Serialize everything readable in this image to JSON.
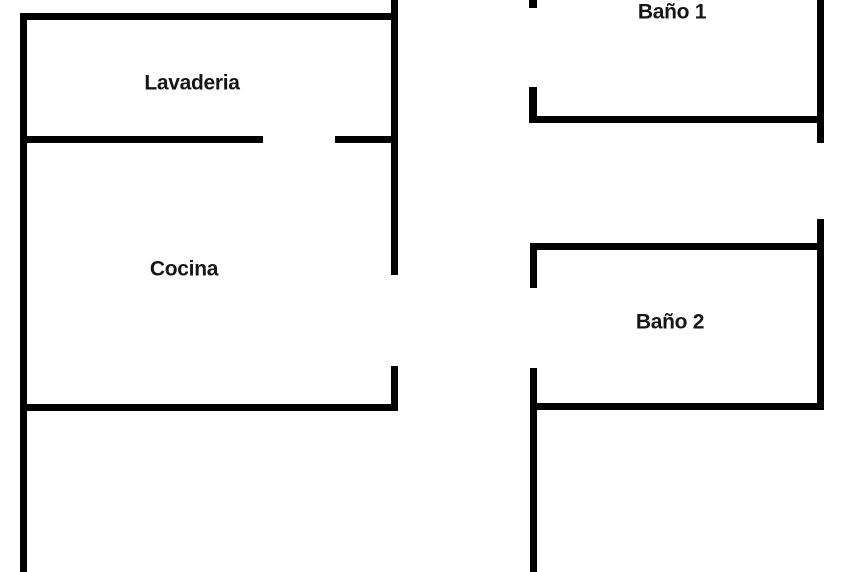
{
  "diagram": {
    "type": "floor-plan",
    "background_color": "#ffffff",
    "wall_color": "#000000",
    "label_color": "#161616",
    "rooms": [
      {
        "name": "Lavaderia",
        "label_x": 192,
        "label_y": 83
      },
      {
        "name": "Cocina",
        "label_x": 184,
        "label_y": 269
      },
      {
        "name": "Baño 1",
        "label_x": 672,
        "label_y": 12
      },
      {
        "name": "Baño 2",
        "label_x": 670,
        "label_y": 322
      }
    ],
    "walls": [
      {
        "id": "left-column-west-wall",
        "x": 20,
        "y": 13,
        "w": 7,
        "h": 559
      },
      {
        "id": "left-column-north-wall",
        "x": 20,
        "y": 13,
        "w": 378,
        "h": 7
      },
      {
        "id": "left-column-east-wall-upper",
        "x": 391,
        "y": 0,
        "w": 7,
        "h": 275
      },
      {
        "id": "lavaderia-cocina-divider-left",
        "x": 20,
        "y": 136,
        "w": 243,
        "h": 7
      },
      {
        "id": "lavaderia-cocina-divider-right",
        "x": 335,
        "y": 136,
        "w": 63,
        "h": 7
      },
      {
        "id": "cocina-south-wall",
        "x": 20,
        "y": 404,
        "w": 378,
        "h": 7
      },
      {
        "id": "left-column-east-wall-lower",
        "x": 391,
        "y": 366,
        "w": 7,
        "h": 45
      },
      {
        "id": "bano1-west-wall-tick",
        "x": 529,
        "y": 0,
        "w": 8,
        "h": 8
      },
      {
        "id": "bano1-west-wall-lower",
        "x": 529,
        "y": 87,
        "w": 8,
        "h": 36
      },
      {
        "id": "bano1-south-wall",
        "x": 529,
        "y": 116,
        "w": 295,
        "h": 7
      },
      {
        "id": "bano1-east-wall",
        "x": 817,
        "y": 0,
        "w": 7,
        "h": 143
      },
      {
        "id": "bano2-east-wall",
        "x": 817,
        "y": 219,
        "w": 7,
        "h": 191
      },
      {
        "id": "bano2-north-wall",
        "x": 531,
        "y": 243,
        "w": 293,
        "h": 7
      },
      {
        "id": "bano2-west-wall-upper",
        "x": 530,
        "y": 243,
        "w": 7,
        "h": 45
      },
      {
        "id": "bano2-west-wall-lower",
        "x": 530,
        "y": 368,
        "w": 7,
        "h": 204
      },
      {
        "id": "bano2-south-wall",
        "x": 531,
        "y": 403,
        "w": 293,
        "h": 7
      }
    ]
  }
}
